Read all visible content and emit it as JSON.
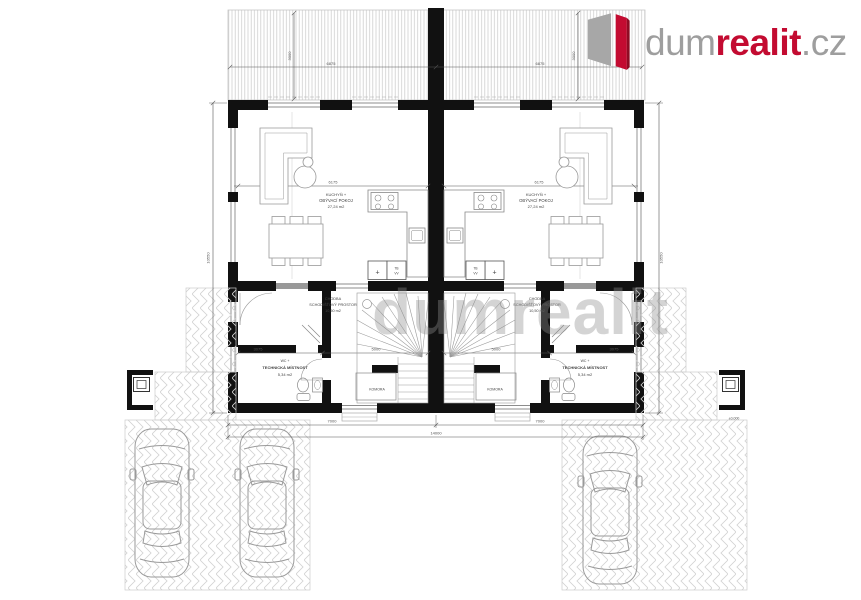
{
  "brand": {
    "prefix": "dum",
    "highlight": "realit",
    "suffix": ".cz"
  },
  "watermark": "dumrealit",
  "plan": {
    "rooms": {
      "living": {
        "line1": "KUCHYŇ +",
        "line2": "OBÝVACÍ POKOJ",
        "area": "27,24 m2"
      },
      "hall": {
        "line1": "CHODBA",
        "line2": "SCHODIŠŤOVÝ PROSTOR",
        "area": "10,50 m2"
      },
      "tech": {
        "line1": "WC +",
        "line2": "TECHNICKÁ MÍSTNOST",
        "area": "5,34 m2"
      },
      "closet": {
        "name": "KOMORA"
      }
    },
    "appliances": {
      "plus": "+",
      "tb": "TB",
      "vv": "VV"
    },
    "levels": {
      "datum": "±0,000"
    },
    "dims": {
      "canopy_half": "6875",
      "canopy_depth": "3000",
      "living_width": "6175",
      "seg_a": "3075",
      "seg_b": "5000",
      "unit_width": "7000",
      "total_width": "14000",
      "side_height": "10550"
    }
  }
}
